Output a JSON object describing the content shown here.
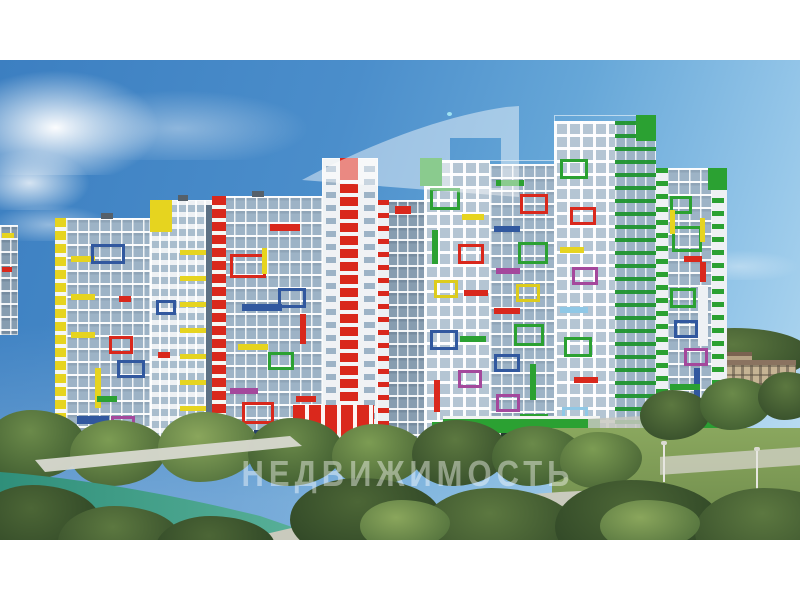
{
  "watermark": {
    "wordmark": "НЕДВИЖИМОСТЬ",
    "logo_shape": "translucent white swoosh flag with square cutout"
  },
  "scene": {
    "description": "3D architectural rendering of a residential complex: white and glass high-rise towers decorated with multicolored facade frames, green tree bank, stone embankment and a teal river in the foreground, blue sky with clouds, white letterbox bands top and bottom",
    "sky_colors": [
      "#3c7fc1",
      "#b6dbf2"
    ],
    "river_color": "#2f8f7a",
    "facade_accent_colors": {
      "red": "#d9281c",
      "green": "#2ba132",
      "yellow": "#e6d41f",
      "blue": "#31589f",
      "cyan": "#8fc8e6",
      "magenta": "#a4489c"
    },
    "elements": [
      "sky",
      "clouds",
      "eight residential towers with colored accents",
      "red entrance podium",
      "green commercial podium",
      "green podium with arch",
      "background brick buildings",
      "distant treeline",
      "tree bank",
      "stone embankment path",
      "teal river",
      "pebble shore",
      "street lamps"
    ]
  }
}
